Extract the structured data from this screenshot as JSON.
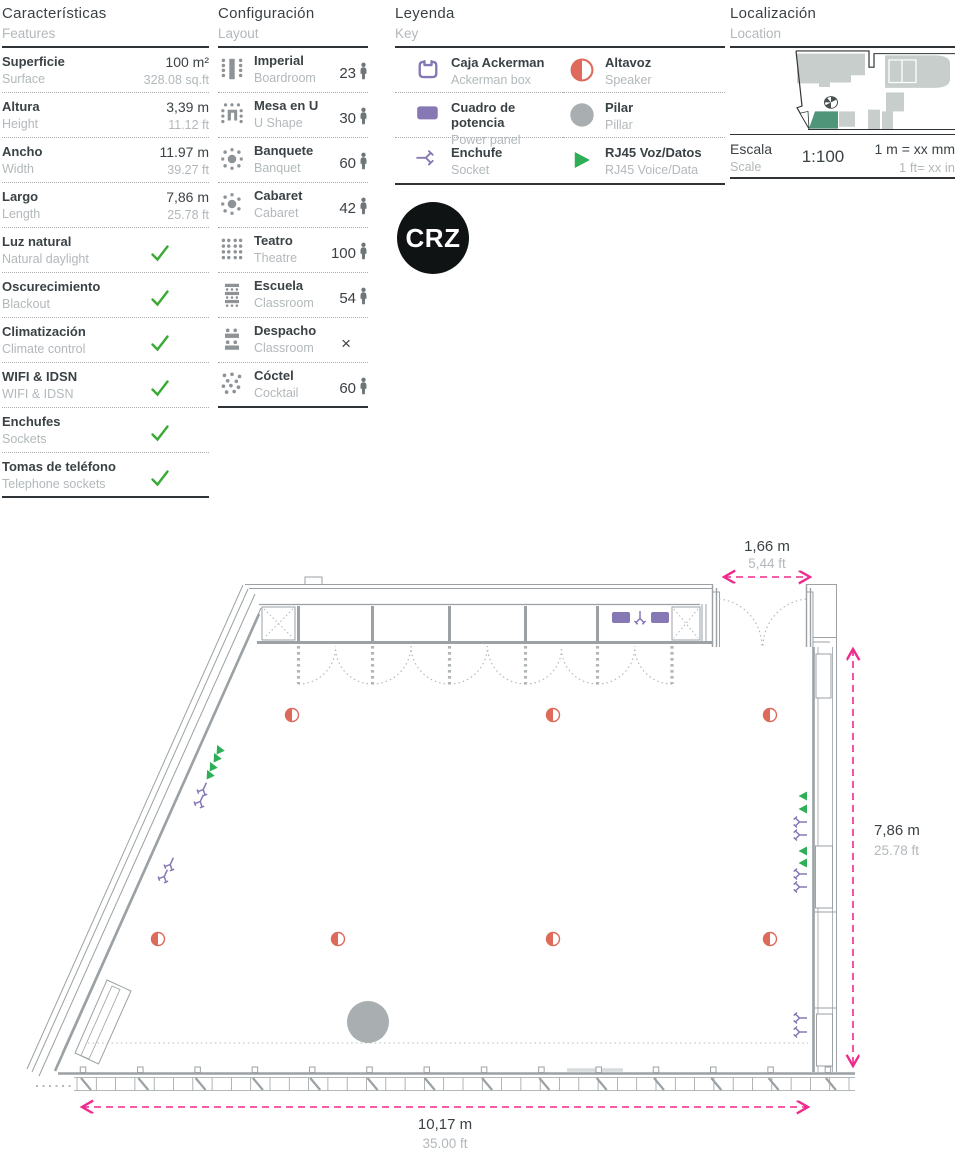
{
  "features": {
    "title": "Características",
    "subtitle": "Features",
    "rows": [
      {
        "label": "Superficie",
        "sublabel": "Surface",
        "value": "100 m²",
        "subvalue": "328.08 sq.ft"
      },
      {
        "label": "Altura",
        "sublabel": "Height",
        "value": "3,39 m",
        "subvalue": "11.12 ft"
      },
      {
        "label": "Ancho",
        "sublabel": "Width",
        "value": "11.97 m",
        "subvalue": "39.27 ft"
      },
      {
        "label": "Largo",
        "sublabel": "Length",
        "value": "7,86 m",
        "subvalue": "25.78 ft"
      },
      {
        "label": "Luz natural",
        "sublabel": "Natural daylight",
        "check": true
      },
      {
        "label": "Oscurecimiento",
        "sublabel": "Blackout",
        "check": true
      },
      {
        "label": "Climatización",
        "sublabel": "Climate control",
        "check": true
      },
      {
        "label": "WIFI & IDSN",
        "sublabel": "WIFI & IDSN",
        "check": true
      },
      {
        "label": "Enchufes",
        "sublabel": "Sockets",
        "check": true
      },
      {
        "label": "Tomas de teléfono",
        "sublabel": "Telephone sockets",
        "check": true
      }
    ]
  },
  "layout": {
    "title": "Configuración",
    "subtitle": "Layout",
    "rows": [
      {
        "icon": "imperial",
        "label": "Imperial",
        "sublabel": "Boardroom",
        "capacity": "23",
        "person": true
      },
      {
        "icon": "ushape",
        "label": "Mesa en U",
        "sublabel": "U Shape",
        "capacity": "30",
        "person": true
      },
      {
        "icon": "banquet",
        "label": "Banquete",
        "sublabel": "Banquet",
        "capacity": "60",
        "person": true
      },
      {
        "icon": "cabaret",
        "label": "Cabaret",
        "sublabel": "Cabaret",
        "capacity": "42",
        "person": true
      },
      {
        "icon": "theatre",
        "label": "Teatro",
        "sublabel": "Theatre",
        "capacity": "100",
        "person": true
      },
      {
        "icon": "school",
        "label": "Escuela",
        "sublabel": "Classroom",
        "capacity": "54",
        "person": true
      },
      {
        "icon": "office",
        "label": "Despacho",
        "sublabel": "Classroom",
        "capacity": "×",
        "person": false
      },
      {
        "icon": "cocktail",
        "label": "Cóctel",
        "sublabel": "Cocktail",
        "capacity": "60",
        "person": true
      }
    ]
  },
  "legend": {
    "title": "Leyenda",
    "subtitle": "Key",
    "columns": [
      [
        {
          "icon": "ackerman-box",
          "label": "Caja Ackerman",
          "sublabel": "Ackerman box"
        },
        {
          "icon": "power-panel",
          "label": "Cuadro de potencia",
          "sublabel": "Power panel"
        },
        {
          "icon": "socket",
          "label": "Enchufe",
          "sublabel": "Socket"
        }
      ],
      [
        {
          "icon": "speaker",
          "label": "Altavoz",
          "sublabel": "Speaker"
        },
        {
          "icon": "pillar",
          "label": "Pilar",
          "sublabel": "Pillar"
        },
        {
          "icon": "rj45",
          "label": "RJ45 Voz/Datos",
          "sublabel": "RJ45 Voice/Data"
        }
      ]
    ]
  },
  "location": {
    "title": "Localización",
    "subtitle": "Location"
  },
  "scale": {
    "label": "Escala",
    "sublabel": "Scale",
    "value": "1:100",
    "metric": "1 m = xx mm",
    "imperial": "1 ft= xx in"
  },
  "logo": {
    "text": "CRZ"
  },
  "plan": {
    "dimensions": {
      "top": {
        "meters": "1,66 m",
        "feet": "5,44 ft"
      },
      "right": {
        "meters": "7,86 m",
        "feet": "25.78 ft"
      },
      "bottom": {
        "meters": "10,17 m",
        "feet": "35.00 ft"
      }
    },
    "speakers": [
      [
        292,
        199
      ],
      [
        553,
        199
      ],
      [
        770,
        199
      ],
      [
        158,
        423
      ],
      [
        338,
        423
      ],
      [
        553,
        423
      ],
      [
        770,
        423
      ]
    ],
    "pillar": {
      "x": 368,
      "y": 506,
      "r": 21
    },
    "rj45_outlets": [
      [
        219,
        233,
        -115
      ],
      [
        216,
        241,
        -115
      ],
      [
        212,
        250,
        -115
      ],
      [
        209,
        258,
        -115
      ],
      [
        803,
        280,
        180
      ],
      [
        803,
        293,
        180
      ],
      [
        803,
        335,
        180
      ],
      [
        803,
        347,
        180
      ]
    ],
    "sockets": [
      [
        203,
        274,
        115
      ],
      [
        200,
        286,
        115
      ],
      [
        170,
        349,
        115
      ],
      [
        164,
        361,
        115
      ],
      [
        799,
        306,
        180
      ],
      [
        799,
        319,
        180
      ],
      [
        799,
        358,
        180
      ],
      [
        799,
        371,
        180
      ],
      [
        799,
        502,
        180
      ],
      [
        799,
        516,
        180
      ]
    ],
    "power_panels": [
      [
        612,
        96
      ],
      [
        651,
        96
      ]
    ],
    "panel_socket": [
      640,
      103,
      90
    ],
    "colors": {
      "dimension_pink": "#ee2a8c",
      "check_green": "#3aaa35",
      "rj45_green": "#2eae56",
      "symbol_purple": "#8678b5",
      "speaker_red": "#dd6a5a",
      "pillar_gray": "#a9aeb1",
      "room_green": "#4f9579"
    }
  }
}
